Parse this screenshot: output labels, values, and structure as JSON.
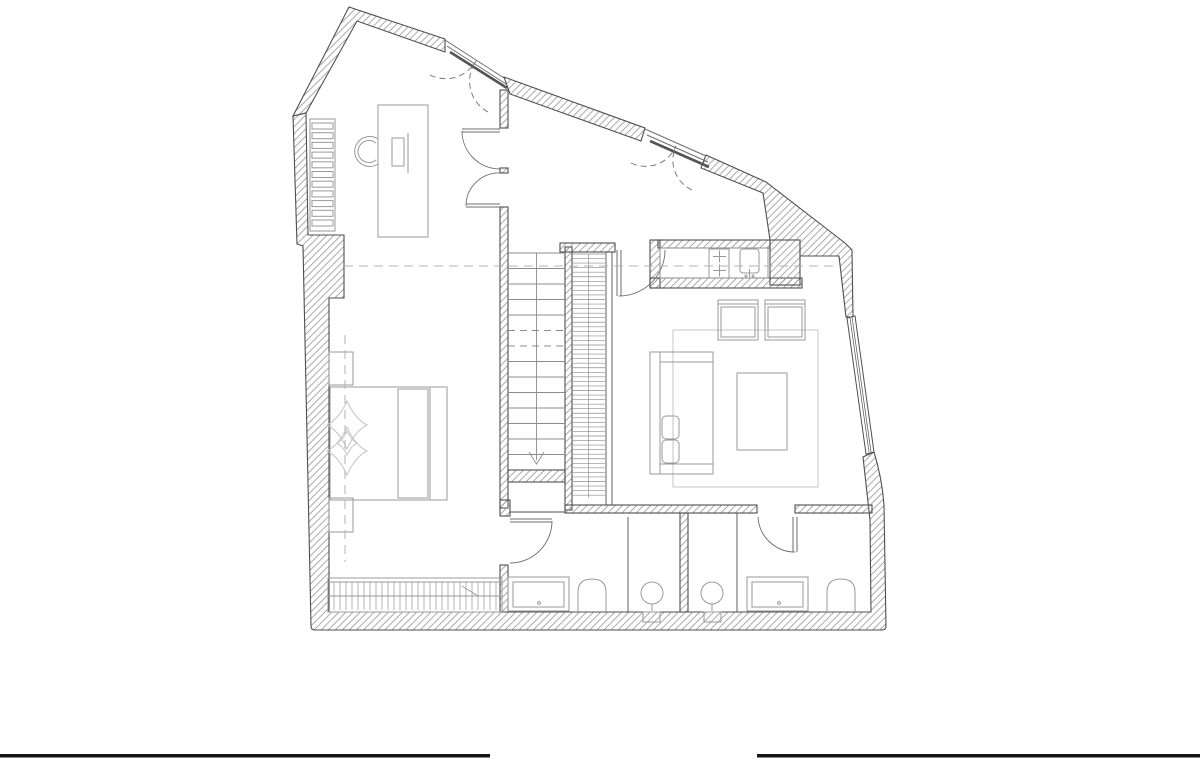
{
  "canvas": {
    "width": 1200,
    "height": 768,
    "background": "#ffffff"
  },
  "palette": {
    "background": "#ffffff",
    "wall_line": "#4f4f4f",
    "wall_hatch": "#9b9b9b",
    "furniture_line": "#9a9a9a",
    "light_line": "#c6c6c6",
    "door_line": "#6e6e6e",
    "stair_line": "#8c8c8c",
    "dash_line": "#b3b3b3",
    "crop_mark": "#161616"
  },
  "plan": {
    "type": "architectural-floor-plan",
    "rooms": [
      {
        "name": "office"
      },
      {
        "name": "entry-hall"
      },
      {
        "name": "kitchen-nook"
      },
      {
        "name": "living-room"
      },
      {
        "name": "bedroom"
      },
      {
        "name": "bathroom-left"
      },
      {
        "name": "bathroom-right"
      },
      {
        "name": "stair-landing"
      }
    ],
    "stairs": {
      "flights": 2,
      "left_flight_treads": 14,
      "right_flight_treads": 54,
      "dashed_tread_indices": [
        5,
        6
      ],
      "direction_marker": "down-arrow"
    },
    "doors": {
      "exterior_double_doors": 2,
      "interior_swing_doors": 5
    },
    "window": {
      "count": 1,
      "location": "angled-east-wall"
    },
    "wardrobe_slats": 28,
    "radiator_bars": 11,
    "furniture_symbols": [
      "desk",
      "desk-chair",
      "monitor",
      "radiator",
      "bed",
      "pillow",
      "headboard",
      "bedspread-diamonds",
      "nightstand-top",
      "nightstand-bottom",
      "wardrobe",
      "sofa",
      "sofa-cushions",
      "coffee-table",
      "armchair-left",
      "armchair-right",
      "rug",
      "stove",
      "kitchen-sink",
      "vanity-left",
      "toilet-left",
      "wash-basin-left",
      "vanity-right",
      "toilet-right",
      "wash-basin-right"
    ],
    "crop_marks": {
      "bottom_left_bar": true,
      "bottom_right_bar": true
    }
  }
}
